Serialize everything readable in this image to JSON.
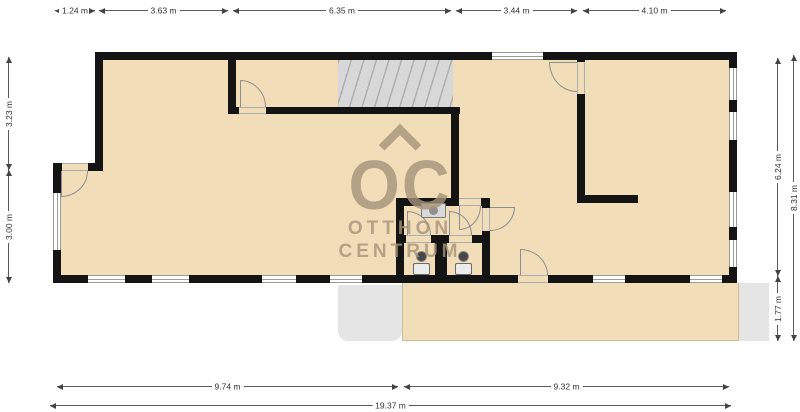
{
  "fp": {
    "watermark": {
      "logo": "OC",
      "name_line1": "OTTHON",
      "name_line2": "CENTRUM"
    },
    "dims": {
      "top": [
        "1.24 m",
        "3.63 m",
        "6.35 m",
        "3.44 m",
        "4.10 m"
      ],
      "left": [
        "3.23 m",
        "3.00 m"
      ],
      "right": [
        "6.24 m",
        "1.77 m",
        "8.31 m"
      ],
      "bottom": [
        "9.74 m",
        "9.32 m",
        "19.37 m"
      ]
    },
    "colors": {
      "floor": "#f1ddb8",
      "wall": "#141414",
      "window_frame": "#9b9b9b",
      "stairs": "#d8d8d8",
      "exterior_gray": "#e5e5e5",
      "watermark": "#a6947a"
    }
  }
}
